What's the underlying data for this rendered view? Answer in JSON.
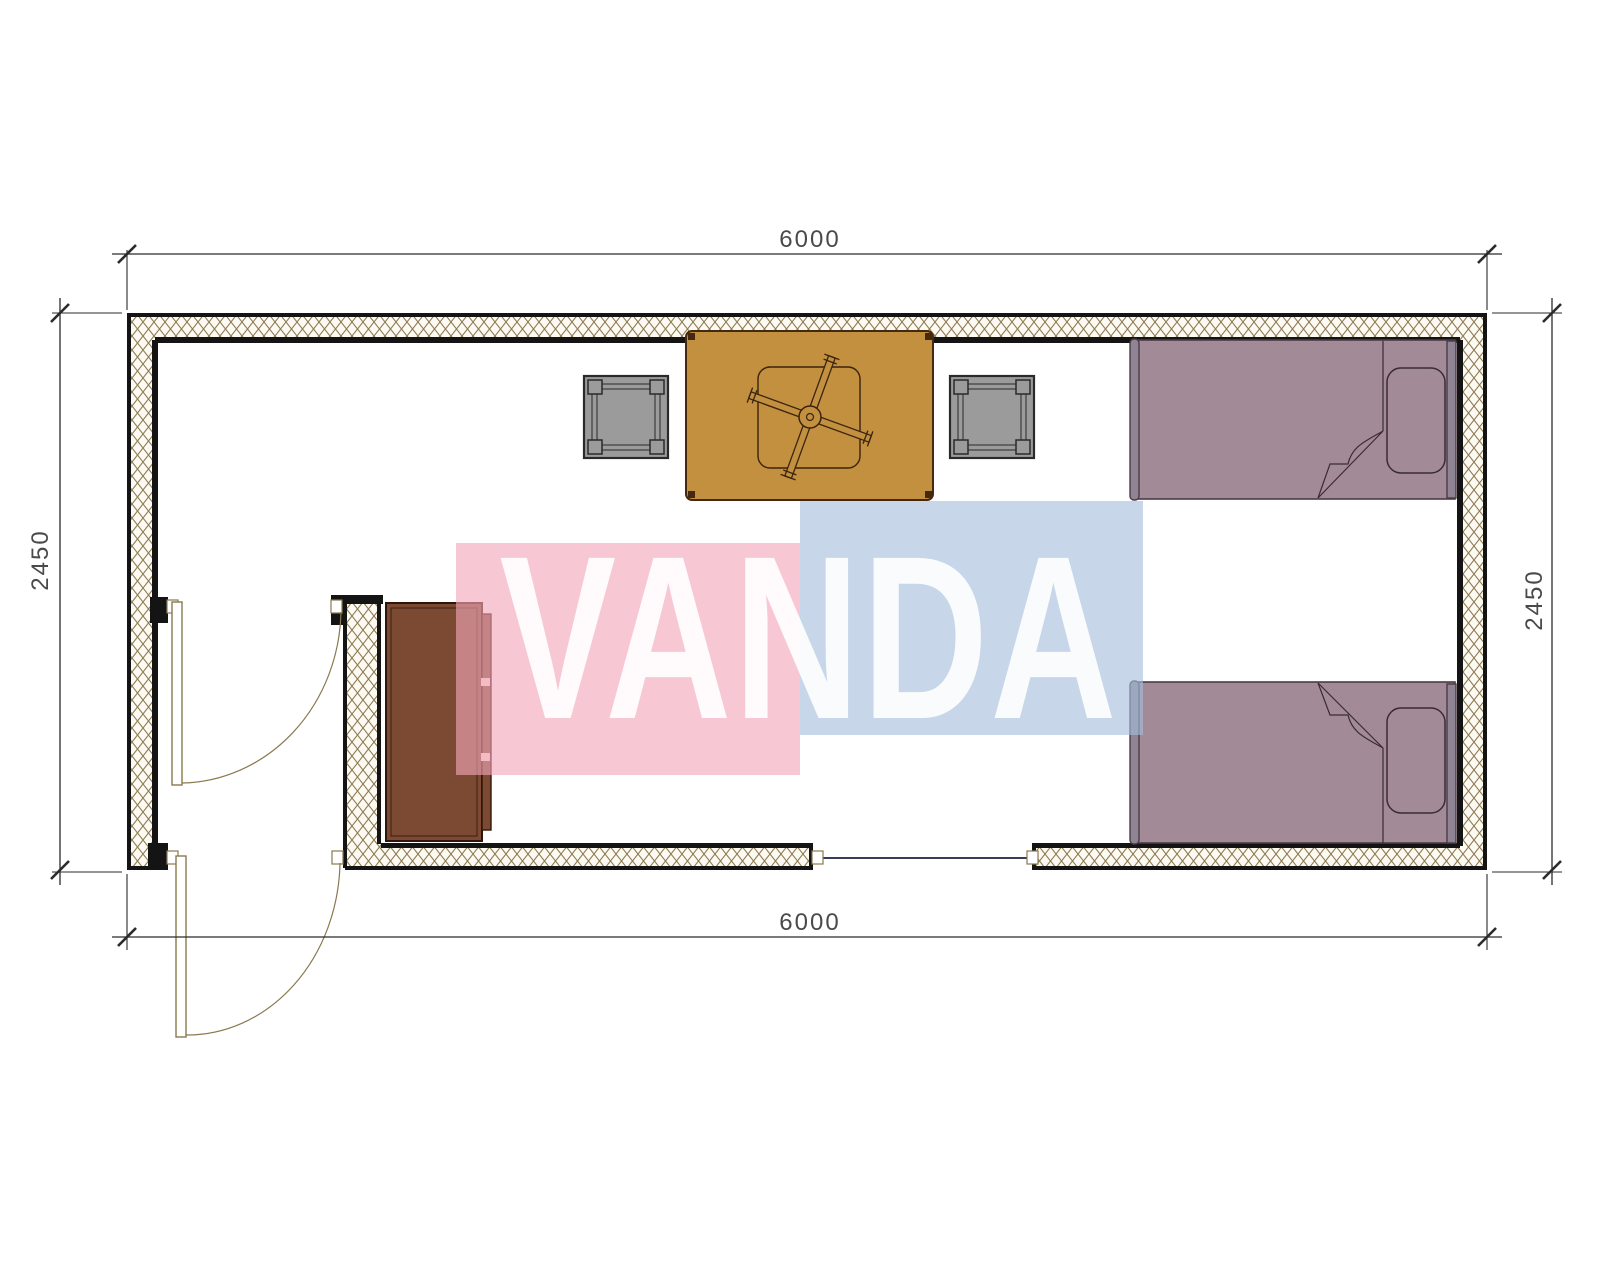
{
  "drawing": {
    "kind": "floor-plan",
    "dimensions": {
      "top": "6000",
      "bottom": "6000",
      "left": "2450",
      "right": "2450"
    },
    "watermark": {
      "text": "VANDA"
    }
  },
  "colors": {
    "wall_line": "#141414",
    "hatch_line": "#8d7b52",
    "hatch_bg": "#fcfaf2",
    "door_line": "#8a7950",
    "window_line": "#3b3b5e",
    "dim_line": "#2b2b2b",
    "dim_text": "#4a4a4a",
    "table_gold": "#c2903f",
    "table_border": "#45290e",
    "stool_gray": "#9b9b9b",
    "stool_border": "#2a2a2a",
    "bed_mauve": "#a28b97",
    "bed_border": "#4c3a45",
    "bed_rail": "#8e8494",
    "cabinet_brown": "#7c4a33",
    "cabinet_border": "#2f150b",
    "watermark_pink": "rgba(242,166,184,0.62)",
    "watermark_blue": "rgba(165,190,220,0.62)",
    "watermark_text": "rgba(255,255,255,0.9)"
  },
  "furniture": {
    "table": "square-table",
    "fan": "fan-symbol",
    "stool_left": "stool",
    "stool_right": "stool",
    "bed_top": "single-bed",
    "bed_bottom": "single-bed",
    "cabinet": "cabinet",
    "door_interior": "swing-door",
    "door_exterior": "swing-door",
    "window_bottom": "window"
  }
}
